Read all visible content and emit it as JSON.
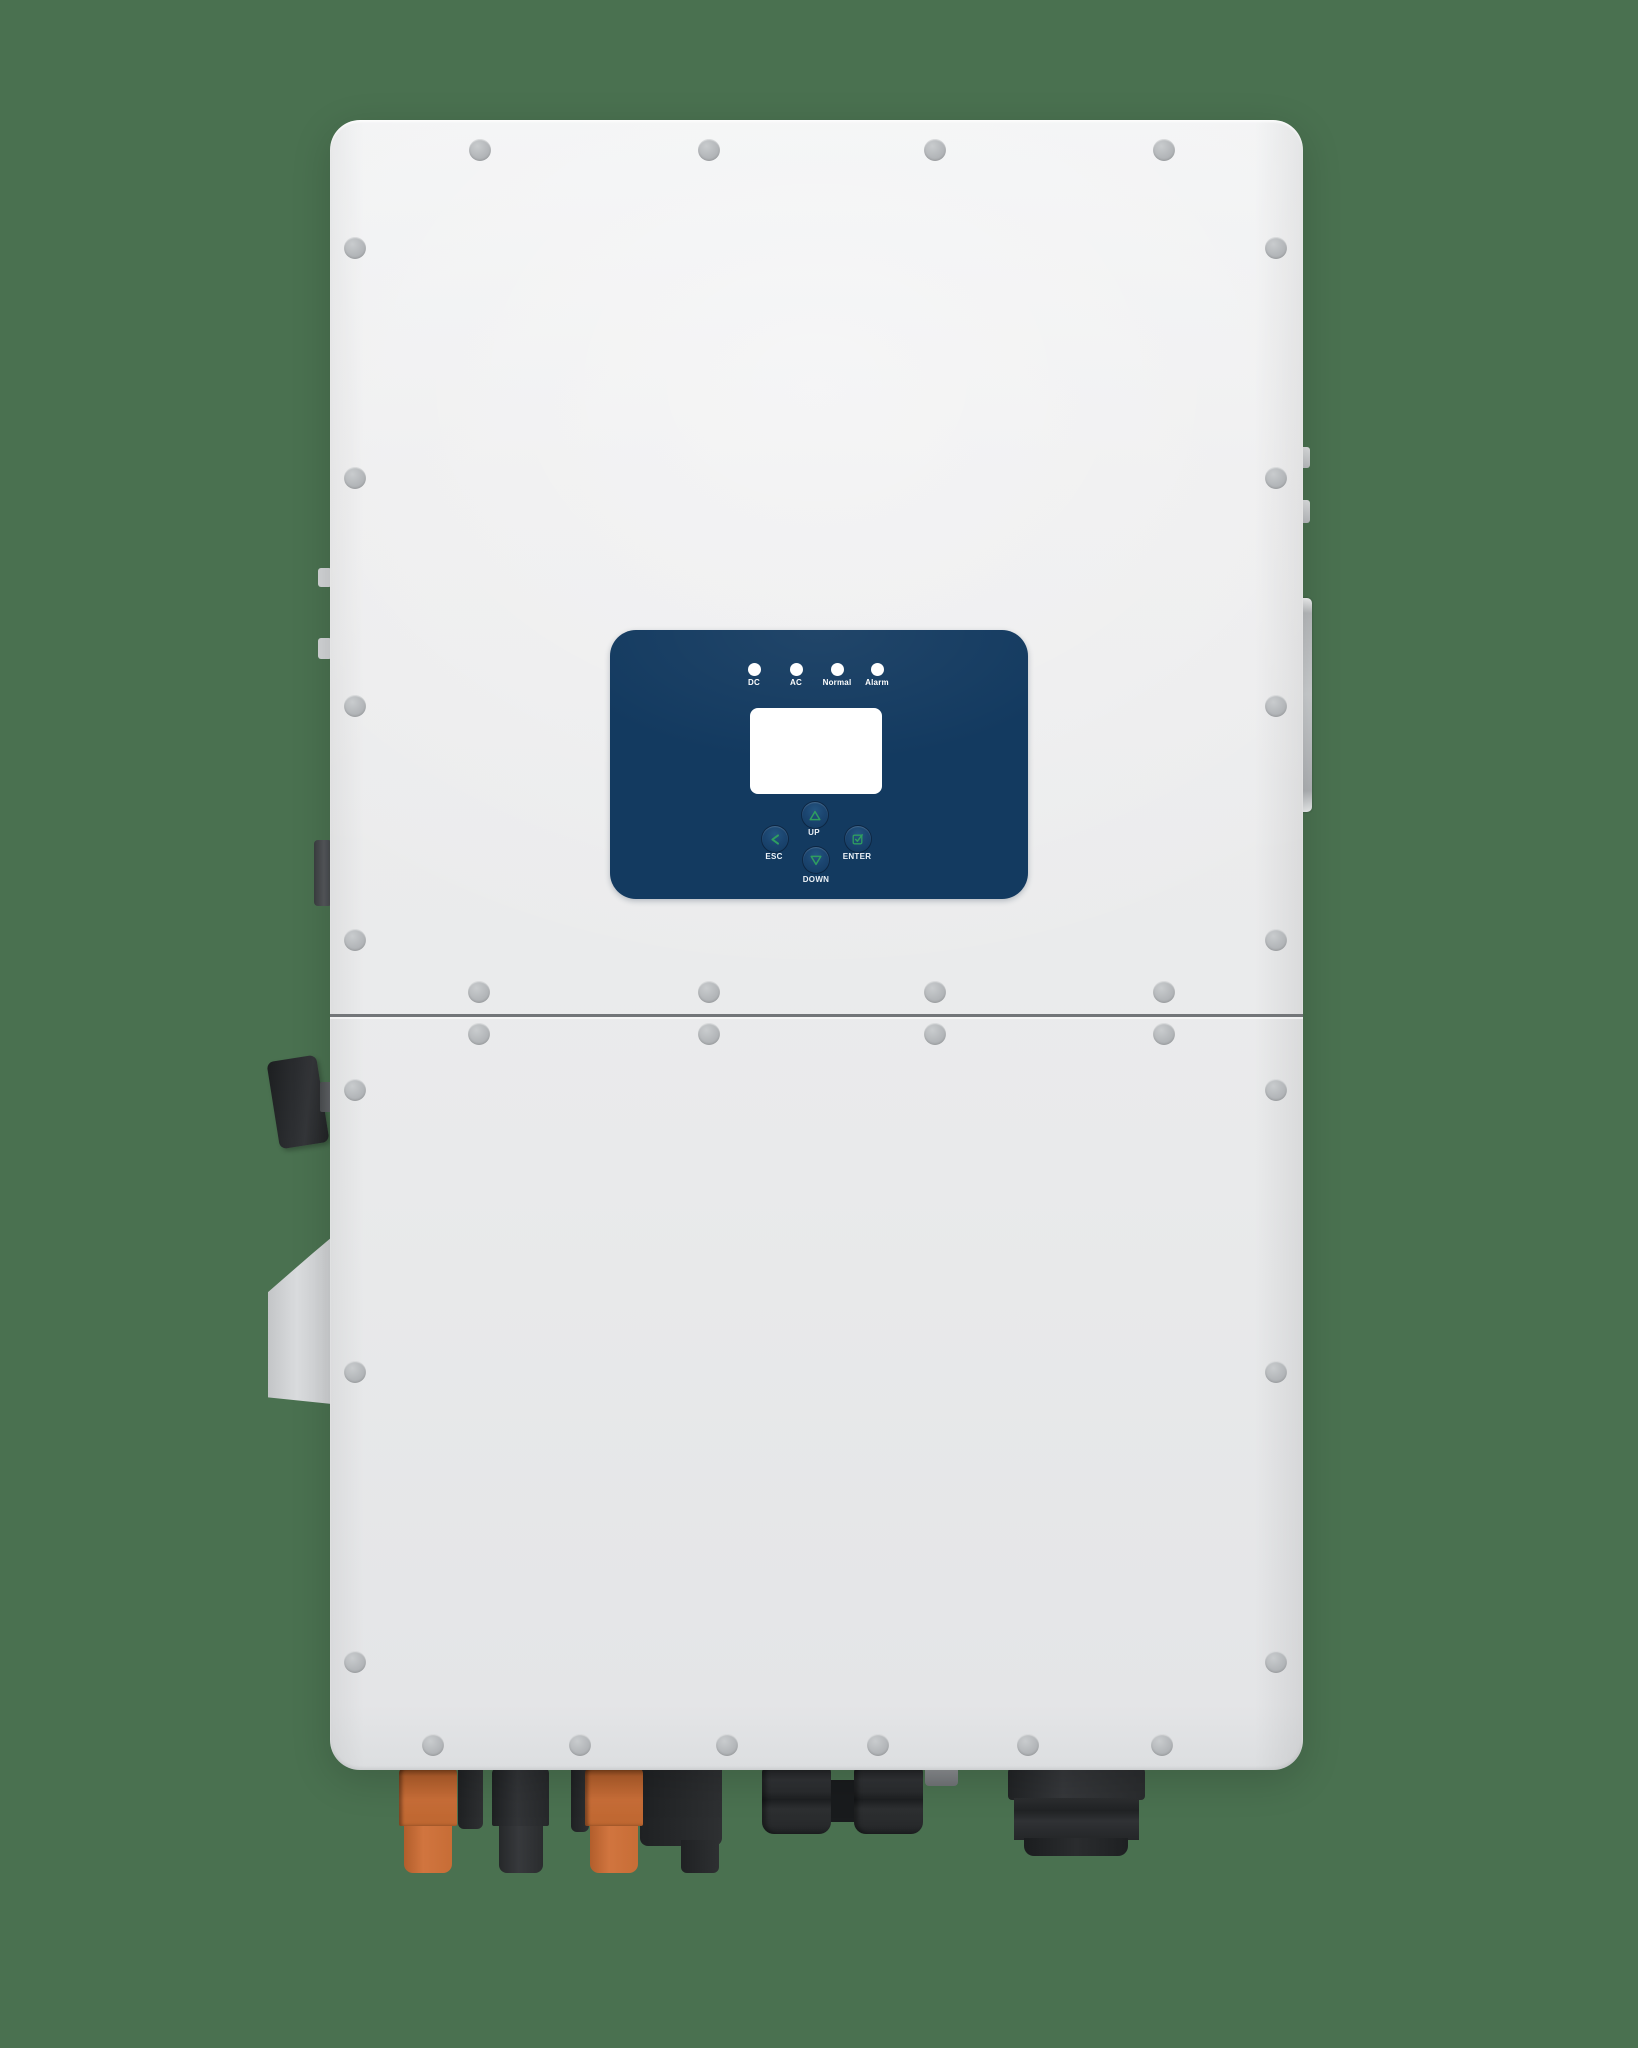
{
  "scene": {
    "background_color": "#4a7150"
  },
  "inverter": {
    "body_color": "#ebedee",
    "seam_color": "#737679",
    "control_panel": {
      "panel_color": "#133a60",
      "screen_color": "#ffffff",
      "led_color": "#ffffff",
      "glyph_color": "#2f9e5f",
      "leds": [
        {
          "name": "dc-led",
          "label": "DC"
        },
        {
          "name": "ac-led",
          "label": "AC"
        },
        {
          "name": "normal-led",
          "label": "Normal"
        },
        {
          "name": "alarm-led",
          "label": "Alarm"
        }
      ],
      "buttons": [
        {
          "name": "esc-button",
          "label": "ESC",
          "icon": "chevron-left-icon"
        },
        {
          "name": "up-button",
          "label": "UP",
          "icon": "triangle-up-icon"
        },
        {
          "name": "enter-button",
          "label": "ENTER",
          "icon": "check-square-icon"
        },
        {
          "name": "down-button",
          "label": "DOWN",
          "icon": "triangle-down-icon"
        }
      ]
    },
    "side_hardware": {
      "dc_switch_color": "#26282a",
      "bracket_color": "#d3d5d7"
    },
    "bottom_connectors": [
      {
        "name": "mc4-connector-orange-1",
        "color": "#c8713c"
      },
      {
        "name": "mc4-connector-black-1",
        "color": "#2c2e30"
      },
      {
        "name": "mc4-connector-orange-2",
        "color": "#c8713c"
      },
      {
        "name": "mc4-connector-black-2",
        "color": "#242628"
      },
      {
        "name": "cable-gland-double",
        "color": "#27292b"
      },
      {
        "name": "cable-gland-large",
        "color": "#2b2d2f"
      }
    ]
  }
}
